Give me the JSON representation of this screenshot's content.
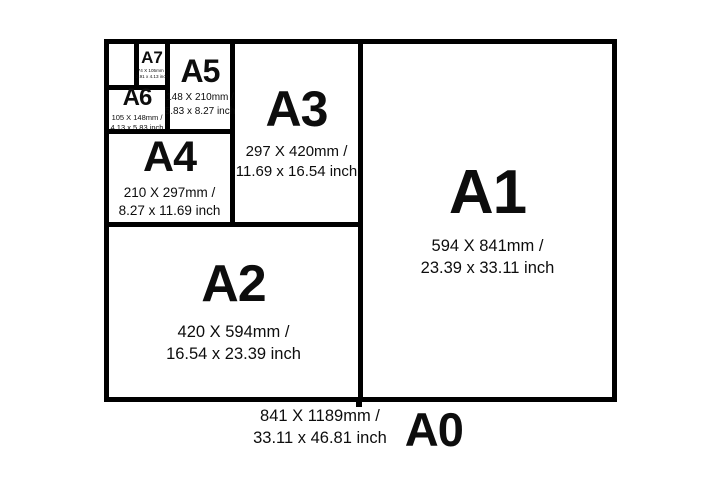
{
  "colors": {
    "background": "#ffffff",
    "line": "#000000",
    "text": "#0d0d0d"
  },
  "sizes": {
    "a0": {
      "label": "A0",
      "mm": "841 X 1189mm /",
      "inch": "33.11 x 46.81 inch"
    },
    "a1": {
      "label": "A1",
      "mm": "594 X 841mm /",
      "inch": "23.39 x 33.11 inch"
    },
    "a2": {
      "label": "A2",
      "mm": "420 X 594mm /",
      "inch": "16.54 x 23.39 inch"
    },
    "a3": {
      "label": "A3",
      "mm": "297 X 420mm /",
      "inch": "11.69 x 16.54 inch"
    },
    "a4": {
      "label": "A4",
      "mm": "210 X 297mm /",
      "inch": "8.27 x 11.69 inch"
    },
    "a5": {
      "label": "A5",
      "mm": "148 X 210mm /",
      "inch": "5.83 x 8.27 inch"
    },
    "a6": {
      "label": "A6",
      "mm": "105 X 148mm /",
      "inch": "4.13 x 5.83 inch"
    },
    "a7": {
      "label": "A7",
      "mm": "74 X 105mm /",
      "inch": "2.91 x 4.13 inch"
    }
  }
}
